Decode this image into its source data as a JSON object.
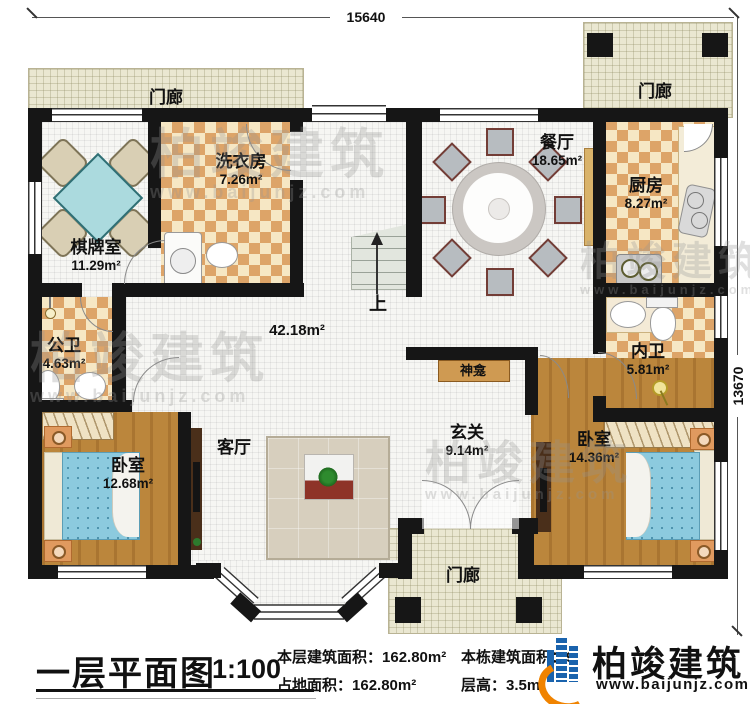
{
  "dimensions": {
    "top": "15640",
    "right": "13670"
  },
  "rooms": {
    "porch": {
      "name": "门廊"
    },
    "qipai": {
      "name": "棋牌室",
      "area": "11.29m²"
    },
    "laundry": {
      "name": "洗衣房",
      "area": "7.26m²"
    },
    "dining": {
      "name": "餐厅",
      "area": "18.65m²"
    },
    "kitchen": {
      "name": "厨房",
      "area": "8.27m²"
    },
    "public_bath": {
      "name": "公卫",
      "area": "4.63m²"
    },
    "inner_bath": {
      "name": "内卫",
      "area": "5.81m²"
    },
    "bedroom_left": {
      "name": "卧室",
      "area": "12.68m²"
    },
    "bedroom_right": {
      "name": "卧室",
      "area": "14.36m²"
    },
    "living": {
      "name": "客厅"
    },
    "foyer": {
      "name": "玄关",
      "area": "9.14m²"
    },
    "hall": {
      "area": "42.18m²"
    },
    "shrine": {
      "name": "神龛"
    },
    "stairs": {
      "up_label": "上"
    }
  },
  "title_block": {
    "title": "一层平面图",
    "scale": "1:100",
    "floor_area_label": "本层建筑面积：",
    "floor_area_value": "162.80m²",
    "land_area_label": "占地面积：",
    "land_area_value": "162.80m²",
    "total_area_label": "本栋建筑面积：",
    "total_area_visible_fragment": "9",
    "floor_height_label": "层高：",
    "floor_height_value": "3.5m"
  },
  "logo": {
    "brand": "柏竣建筑",
    "url": "www.baijunjz.com"
  },
  "watermark": {
    "brand": "柏竣建筑",
    "url": "www.baijunjz.com"
  },
  "colors": {
    "wall": "#161616",
    "checker_tile": "#dda468",
    "wood": "#b07c33",
    "porch": "#eae7d1",
    "bed_blue": "#8ccade",
    "logo_blue": "#1a63ad",
    "logo_orange": "#f08300",
    "shrine_tan": "#cf9a52"
  }
}
